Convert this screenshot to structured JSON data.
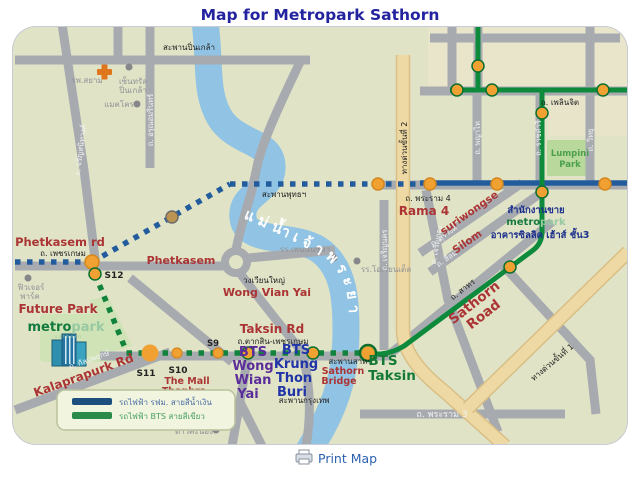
{
  "title": "Map for Metropark Sathorn",
  "footer": {
    "print_label": "Print Map",
    "print_icon": "printer-icon"
  },
  "legend": {
    "items": [
      {
        "swatch_color": "#1d4e7e",
        "label": "รถไฟฟ้า รฟม. สายสีน้ำเงิน"
      },
      {
        "swatch_color": "#2a8a4a",
        "label": "รถไฟฟ้า BTS สายสีเขียว"
      }
    ]
  },
  "colors": {
    "title_navy": "#2323a0",
    "map_background": "#e0e3c6",
    "road_gray": "#a7abb0",
    "river_blue": "#90c3e4",
    "expressway_tan": "#eed9a4",
    "mrt_blue_line": "#235c9d",
    "bts_green_line": "#0e8a3d",
    "station_orange": "#f0a132",
    "red_label": "#ab3434",
    "purple_label": "#5b2d9b",
    "blue_label": "#2135a8",
    "link_blue": "#2b62b0"
  },
  "map": {
    "labels": {
      "saphan_pinklao": "สะพานปิ่นเกล้า",
      "hospital": "รพ.สยาม",
      "central_1": "เซ็นทรัล",
      "central_2": "ปิ่นเกล้า",
      "makro": "แมคโคร",
      "rd_charan": "ถ. จรัญสนิทวงศ์",
      "rd_arun": "ถ. อรุณอมรินทร์",
      "phetkasem_rd_en": "Phetkasem rd",
      "phetkasem_th": "ถ. เพชรเกษม",
      "phetkasem_en": "Phetkasem",
      "s12": "S12",
      "future_park_th1": "ฟิวเจอร์",
      "future_park_th2": "พาร์ค",
      "future_park_en": "Future Park",
      "logo_metro": "metro",
      "logo_park": "park",
      "logo_sub": "s a t h o r n",
      "rd_kalapapruek_th": "ถ. กัลปพฤกษ์",
      "kalaprapurk_en": "Kalaprapurk Rd",
      "s11": "S11",
      "s10": "S10",
      "the_mall": "The Mall",
      "thaphra": "Thaphra",
      "s9": "S9",
      "taksin_rd_en": "Taksin Rd",
      "taksin_rd_th": "ถ.ตากสิน-เพชรเกษม",
      "bts_wwy": [
        "BTS",
        "Wong",
        "Wian",
        "Yai"
      ],
      "bts_ktb": [
        "BTS",
        "Krung",
        "Thon",
        "Buri"
      ],
      "saphan_sathorn_th": "สะพานสาทร",
      "sathorn_bridge": [
        "Sathorn",
        "Bridge"
      ],
      "saphan_krungthep_th": "สะพานกรุงเทพ",
      "bts_taksin": [
        "BTS",
        "Taksin"
      ],
      "bigc_1": "บิ๊กซี",
      "bigc_2": "ดาวคะนอง",
      "wongwianyai_th": "วงเวียนใหญ่",
      "wongwianyai_en": "Wong Vian Yai",
      "saphan_phut_th": "สะพานพุทธฯ",
      "peninsula": "รร.เพนนินซูล่า",
      "oriental": "รร.โอเรียนเต็ล",
      "river": "แม่น้ำเจ้าพระยา",
      "rd_charoen_nakhon": "ถ. เจริญนคร",
      "rd_charoen_krung": "ถ. เจริญกรุง",
      "rama4_th": "ถ. พระราม 4",
      "rama4_en": "Rama 4",
      "surawong_th": "ถ. สุรวงศ์",
      "surawong_en": "suriwongse",
      "silom_th": "ถ. สีลม",
      "silom_en": "Silom",
      "sathorn_th": "ถ. สาทร",
      "sathorn_road": [
        "Sathorn",
        "Road"
      ],
      "sales_office_th": "สำนักงานขาย",
      "zuellig_th": "อาคารซิลลิค เฮ้าส์ ชั้น3",
      "ploenchit_th": "ถ. เพลินจิต",
      "phayathai_th": "ถ. พญาไท",
      "ratchadamri_th": "ถ. ราชดำริ",
      "witthayu_th": "ถ. วิทยุ",
      "lumpini": [
        "Lumpini",
        "Park"
      ],
      "rama3_th": "ถ. พระราม 3",
      "expressway2_th": "ทางด่วนขั้นที่ 2",
      "expressway1_th": "ทางด่วนขั้นที่ 1"
    }
  }
}
